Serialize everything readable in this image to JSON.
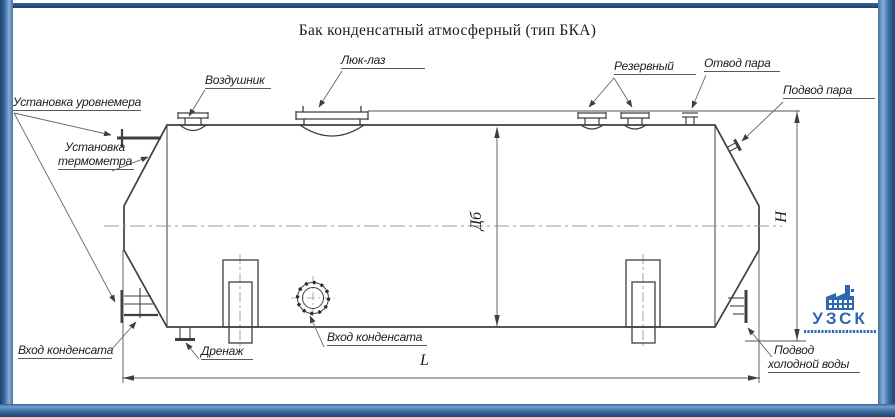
{
  "title": "Бак конденсатный атмосферный (тип БКА)",
  "labels": {
    "level_gauge": "Установка уровнемера",
    "thermometer_l1": "Установка",
    "thermometer_l2": "термометра",
    "air_vent": "Воздушник",
    "manhole": "Люк-лаз",
    "reserve": "Резервный",
    "steam_outlet": "Отвод пара",
    "steam_inlet": "Подвод пара",
    "condensate_inlet_left": "Вход конденсата",
    "drain": "Дренаж",
    "condensate_inlet_center": "Вход конденсата",
    "cold_water_l1": "Подвод",
    "cold_water_l2": "холодной воды"
  },
  "dimensions": {
    "length": "L",
    "height": "H",
    "diameter": "Дб"
  },
  "logo": {
    "name": "УЗСК"
  },
  "colors": {
    "frame_blue": "#3e6ca8",
    "logo_blue": "#2f66b0",
    "line_dark": "#3f3f3f"
  }
}
